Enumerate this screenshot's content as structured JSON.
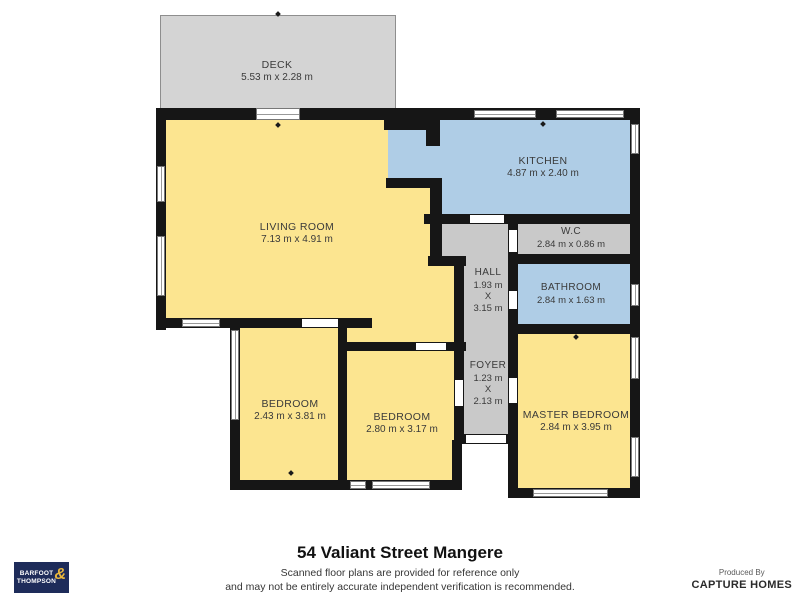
{
  "colors": {
    "yellow": "#fce590",
    "blue": "#afcde6",
    "gray": "#c9c9c9",
    "deck": "#d4d4d4",
    "wall": "#161616",
    "logo_navy": "#1e2c5a",
    "logo_gold": "#eab73c"
  },
  "plan": {
    "rooms": [
      {
        "id": "deck",
        "label": "DECK",
        "dims": "5.53 m x 2.28 m"
      },
      {
        "id": "living-room",
        "label": "LIVING ROOM",
        "dims": "7.13 m x 4.91 m"
      },
      {
        "id": "kitchen",
        "label": "KITCHEN",
        "dims": "4.87 m x 2.40 m"
      },
      {
        "id": "wc",
        "label": "W.C",
        "dims": "2.84 m x 0.86 m"
      },
      {
        "id": "hall",
        "label": "HALL",
        "dim_w": "1.93 m",
        "sep": "X",
        "dim_h": "3.15 m"
      },
      {
        "id": "bathroom",
        "label": "BATHROOM",
        "dims": "2.84 m x 1.63 m"
      },
      {
        "id": "foyer",
        "label": "FOYER",
        "dim_w": "1.23 m",
        "sep": "X",
        "dim_h": "2.13 m"
      },
      {
        "id": "bedroom-1",
        "label": "BEDROOM",
        "dims": "2.43 m x 3.81 m"
      },
      {
        "id": "bedroom-2",
        "label": "BEDROOM",
        "dims": "2.80 m x 3.17 m"
      },
      {
        "id": "master-bedroom",
        "label": "MASTER BEDROOM",
        "dims": "2.84 m x 3.95 m"
      }
    ]
  },
  "footer": {
    "title": "54 Valiant Street Mangere",
    "disclaimer_line1": "Scanned floor plans are provided for reference only",
    "disclaimer_line2": "and may not be entirely accurate independent verification is recommended.",
    "logo": {
      "line1": "BARFOOT",
      "line2": "THOMPSON",
      "amp": "&"
    },
    "produced_by": "Produced By",
    "producer": "CAPTURE HOMES"
  }
}
